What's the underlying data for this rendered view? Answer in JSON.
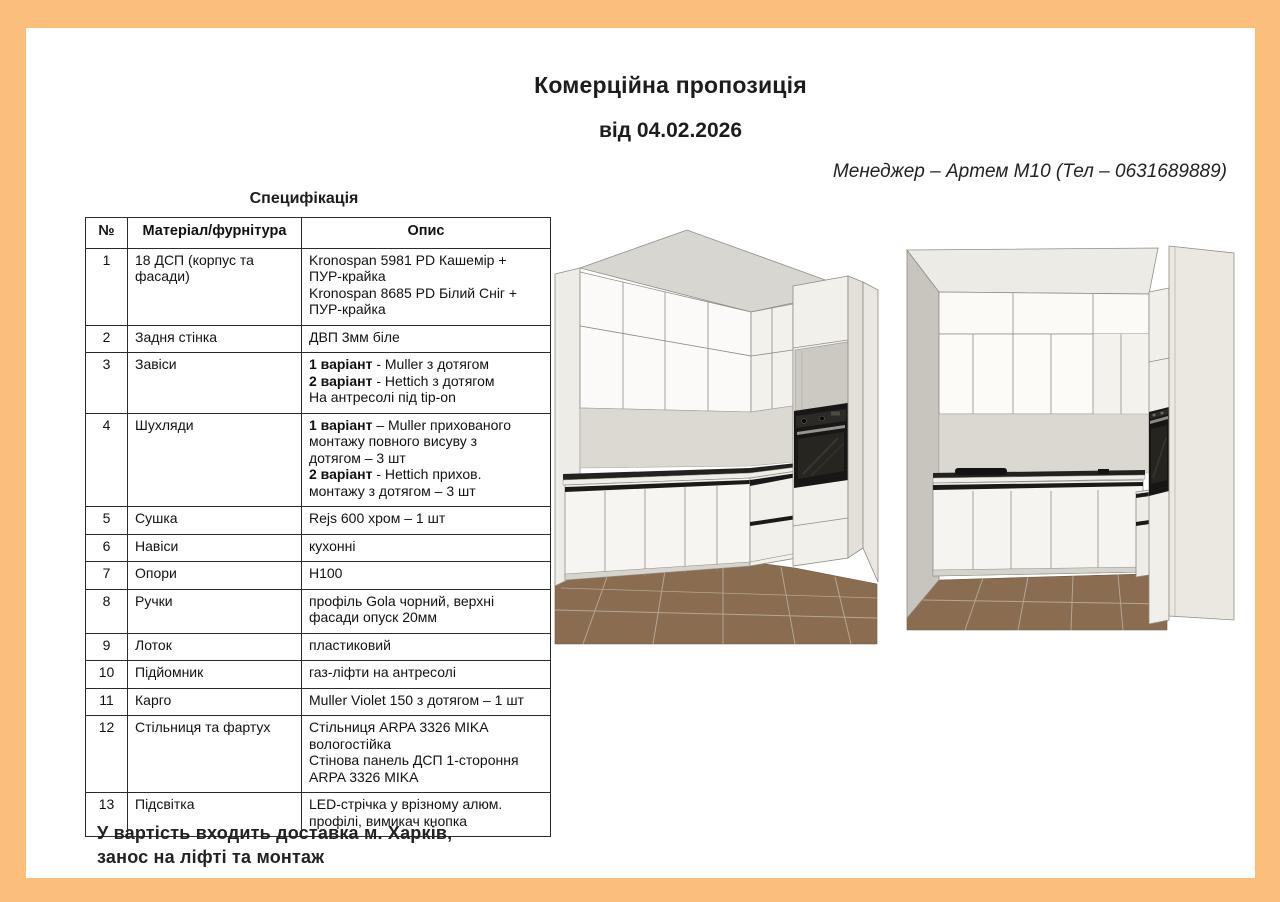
{
  "header": {
    "title": "Комерційна пропозиція",
    "date_line": "від 04.02.2026",
    "manager_line": "Менеджер – Артем М10 (Тел – 0631689889)"
  },
  "spec": {
    "caption": "Специфікація",
    "columns": [
      "№",
      "Матеріал/фурнітура",
      "Опис"
    ],
    "rows": [
      {
        "num": "1",
        "material": "18 ДСП (корпус та фасади)",
        "desc": [
          [
            {
              "t": "Kronospan 5981 PD Кашемір +"
            }
          ],
          [
            {
              "t": "ПУР-крайка"
            }
          ],
          [
            {
              "t": "Kronospan 8685 PD Білий Сніг +"
            }
          ],
          [
            {
              "t": "ПУР-крайка"
            }
          ]
        ]
      },
      {
        "num": "2",
        "material": "Задня стінка",
        "desc": [
          [
            {
              "t": "ДВП 3мм біле"
            }
          ]
        ]
      },
      {
        "num": "3",
        "material": "Завіси",
        "desc": [
          [
            {
              "t": "1 варіант",
              "b": true
            },
            {
              "t": " - Muller з дотягом"
            }
          ],
          [
            {
              "t": "2 варіант",
              "b": true
            },
            {
              "t": " - Hettich з дотягом"
            }
          ],
          [
            {
              "t": "На антресолі під tip-on"
            }
          ]
        ]
      },
      {
        "num": "4",
        "material": "Шухляди",
        "desc": [
          [
            {
              "t": "1 варіант",
              "b": true
            },
            {
              "t": " – Muller прихованого"
            }
          ],
          [
            {
              "t": "монтажу повного висуву з"
            }
          ],
          [
            {
              "t": "дотягом – 3 шт"
            }
          ],
          [
            {
              "t": "2 варіант",
              "b": true
            },
            {
              "t": " - Hettich прихов."
            }
          ],
          [
            {
              "t": "монтажу з дотягом – 3 шт"
            }
          ]
        ]
      },
      {
        "num": "5",
        "material": "Сушка",
        "desc": [
          [
            {
              "t": "Rejs 600 хром – 1 шт"
            }
          ]
        ]
      },
      {
        "num": "6",
        "material": "Навіси",
        "desc": [
          [
            {
              "t": "кухонні"
            }
          ]
        ]
      },
      {
        "num": "7",
        "material": "Опори",
        "desc": [
          [
            {
              "t": "H100"
            }
          ]
        ]
      },
      {
        "num": "8",
        "material": "Ручки",
        "desc": [
          [
            {
              "t": "профіль Gola чорний, верхні"
            }
          ],
          [
            {
              "t": "фасади опуск 20мм"
            }
          ]
        ]
      },
      {
        "num": "9",
        "material": "Лоток",
        "desc": [
          [
            {
              "t": "пластиковий"
            }
          ]
        ]
      },
      {
        "num": "10",
        "material": "Підйомник",
        "desc": [
          [
            {
              "t": "газ-ліфти на антресолі"
            }
          ]
        ]
      },
      {
        "num": "11",
        "material": "Карго",
        "desc": [
          [
            {
              "t": "Muller Violet 150 з дотягом – 1 шт"
            }
          ]
        ]
      },
      {
        "num": "12",
        "material": "Стільниця та фартух",
        "desc": [
          [
            {
              "t": "Стільниця ARPA 3326 MIKA"
            }
          ],
          [
            {
              "t": "вологостійка"
            }
          ],
          [
            {
              "t": "Стінова панель ДСП 1-стороння"
            }
          ],
          [
            {
              "t": "ARPA 3326 MIKA"
            }
          ]
        ]
      },
      {
        "num": "13",
        "material": "Підсвітка",
        "desc": [
          [
            {
              "t": "LED-стрічка у врізному алюм."
            }
          ],
          [
            {
              "t": "профілі, вимикач кнопка"
            }
          ]
        ]
      }
    ]
  },
  "footer": {
    "line1": "У вартість входить доставка м. Харків,",
    "line2": "занос на ліфті та монтаж"
  },
  "colors": {
    "border_orange": "#fcbe7d",
    "table_line": "#2b2b2b",
    "floor_brown": "#8a6c51",
    "backsplash_gray": "#dbd8d1",
    "oven_black": "#181715",
    "cabinet_white": "#f6f5f1"
  }
}
